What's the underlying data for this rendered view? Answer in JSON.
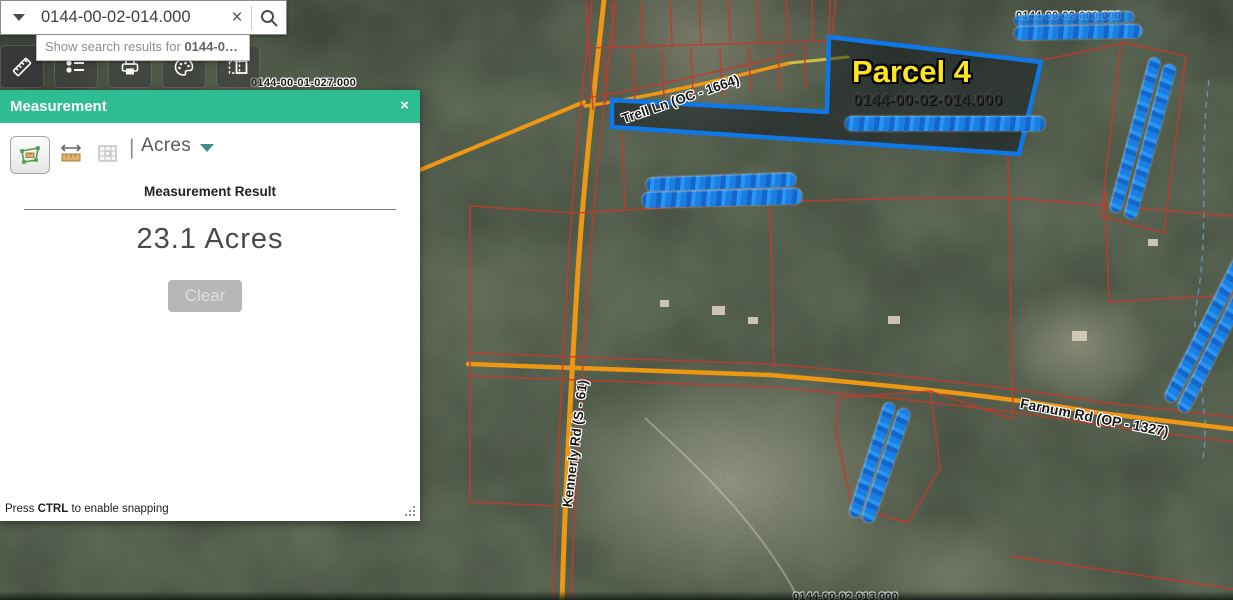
{
  "search": {
    "value": "0144-00-02-014.000",
    "suggestion_prefix": "Show search results for ",
    "suggestion_term": "0144-0…",
    "clear_icon": "×"
  },
  "toolbar": {
    "icons": [
      "ruler-icon",
      "legend-icon",
      "print-icon",
      "draw-icon",
      "swipe-icon"
    ],
    "active_tool": "measure"
  },
  "panel": {
    "title": "Measurement",
    "close_label": "×",
    "unit_separator": "|",
    "unit": "Acres",
    "result_label": "Measurement Result",
    "result_value": "23.1 Acres",
    "clear_label": "Clear",
    "hint_prefix": "Press ",
    "hint_key": "CTRL",
    "hint_suffix": " to enable snapping"
  },
  "map": {
    "selected_parcel_title": "Parcel 4",
    "selected_parcel_id": "0144-00-02-014.000",
    "labels": {
      "kennerly": "Kennerly Rd (S - 61)",
      "farnum": "Farnum Rd (OP - 1327)",
      "trell": "Trell Ln (OC - 1664)"
    },
    "partial_ids": {
      "top_right": "0144-00-02-000.000",
      "panel_edge": "0144-00-01-027.000",
      "bottom": "0144-00-02-013.000"
    },
    "redactions": 9,
    "colors": {
      "panel_header_green": "#2ebd90",
      "parcel_line_red": "#c23b2b",
      "selected_parcel_blue": "#1078e6",
      "road_orange": "#ee9712",
      "redaction_blue": "#1b7ee2",
      "parcel_title_yellow": "#ffe41e"
    }
  }
}
